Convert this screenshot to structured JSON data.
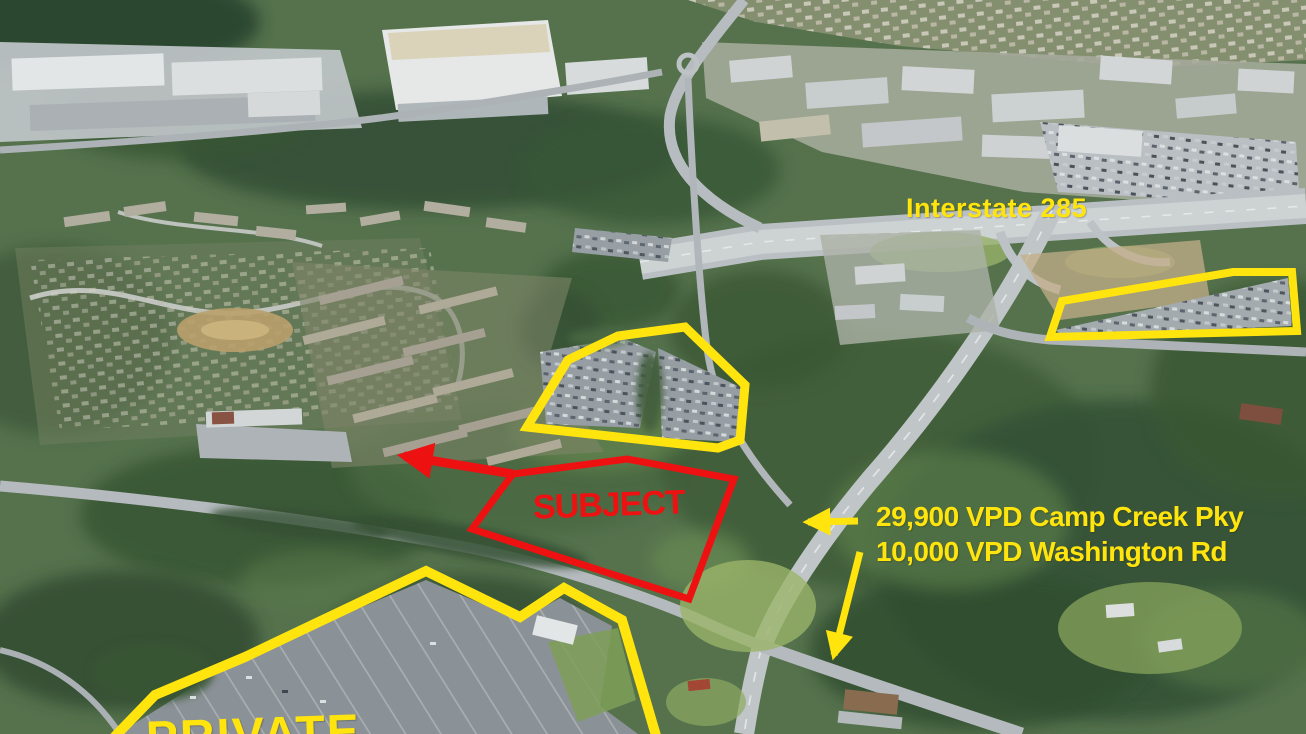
{
  "labels": {
    "interstate": "Interstate 285",
    "traffic_line1": "29,900 VPD Camp Creek Pky",
    "traffic_line2": "10,000 VPD Washington Rd",
    "subject": "SUBJECT",
    "private_partial": "PRIVATE"
  },
  "colors": {
    "annotation_yellow": "#ffe40e",
    "annotation_red": "#ee1111"
  },
  "annotations": {
    "parcels": [
      {
        "id": "retail-parcel-outline-center",
        "color": "yellow",
        "stroke_width": 9,
        "closed": true,
        "points": [
          [
            527,
            427
          ],
          [
            568,
            360
          ],
          [
            618,
            336
          ],
          [
            685,
            327
          ],
          [
            745,
            385
          ],
          [
            740,
            440
          ],
          [
            718,
            448
          ]
        ]
      },
      {
        "id": "retail-parcel-outline-northeast",
        "color": "yellow",
        "stroke_width": 8,
        "closed": true,
        "points": [
          [
            1050,
            337
          ],
          [
            1062,
            301
          ],
          [
            1233,
            272
          ],
          [
            1292,
            272
          ],
          [
            1297,
            331
          ]
        ]
      },
      {
        "id": "private-parcel-outline-southwest",
        "color": "yellow",
        "stroke_width": 10,
        "closed": false,
        "points": [
          [
            96,
            756
          ],
          [
            155,
            695
          ],
          [
            245,
            657
          ],
          [
            426,
            571
          ],
          [
            520,
            617
          ],
          [
            564,
            588
          ],
          [
            622,
            620
          ],
          [
            662,
            756
          ]
        ]
      },
      {
        "id": "subject-parcel-outline",
        "color": "red",
        "stroke_width": 7,
        "closed": true,
        "points": [
          [
            513,
            474
          ],
          [
            627,
            459
          ],
          [
            734,
            479
          ],
          [
            689,
            599
          ],
          [
            472,
            529
          ],
          [
            500,
            491
          ]
        ],
        "arrow": {
          "from": [
            513,
            474
          ],
          "to": [
            404,
            456
          ]
        }
      }
    ],
    "arrows": [
      {
        "id": "traffic-arrow-camp-creek",
        "color": "yellow",
        "stroke_width": 7,
        "from": [
          858,
          521
        ],
        "to": [
          808,
          522
        ]
      },
      {
        "id": "traffic-arrow-washington",
        "color": "yellow",
        "stroke_width": 7,
        "from": [
          860,
          552
        ],
        "to": [
          834,
          655
        ]
      }
    ]
  }
}
